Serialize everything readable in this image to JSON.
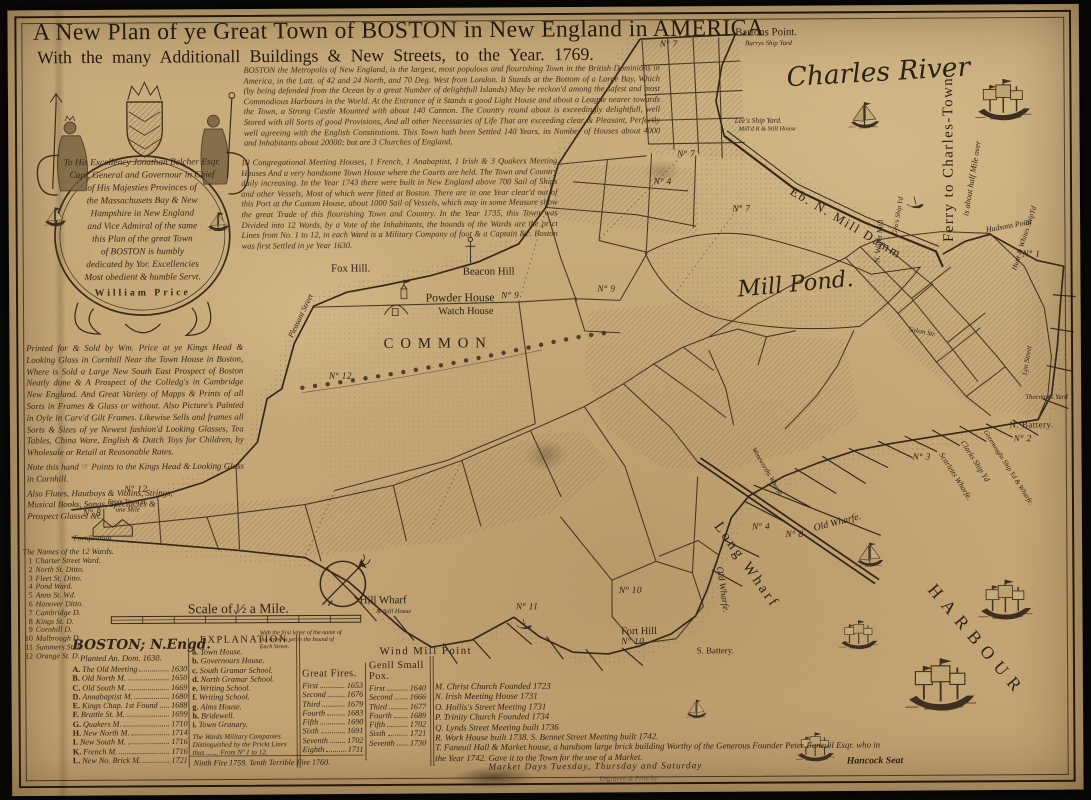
{
  "colors": {
    "paper": "#c9ad7d",
    "ink": "#2b2115",
    "faded_ink": "#6b5638",
    "backdrop": "#0b0a08"
  },
  "title": {
    "line1": "A New Plan of ye Great Town of BOSTON in New England in AMERICA",
    "line2": "With the many Additionall Buildings & New Streets, to the Year. 1769."
  },
  "desc": {
    "block_a": "BOSTON the Metropolis of New England, is the largest, most populous and flourishing Town in the British Dominions in America, in the Latt. of 42 and 24 North, and 70 Deg. West from London. It Stands at the Bottom of a Large Bay, Which (by being defended from the Ocean by a great Number of delightfull Islands) May be reckon'd among the safest and most Commodious Harbours in the World. At the Entrance of it Stands a good Light House and about a League nearer towards the Town, a Strong Castle Mounted with about 140 Cannon. The Country round about is exceedingly delightfull, well Stored with all Sorts of good Provisions, And all other Necessaries of Life That are exceeding clear & Pleasant, Perfectly well agreeing with the English Constitutions. This Town hath been Settled 140 Years, its Number of Houses about 4000 and Inhabitants about 20000; but are 3 Churches of England,",
    "block_b": "10 Congregational Meeting Houses, 1 French, 1 Anabaptist, 1 Irish & 3 Quakers Meeting Houses And a very handsome Town House where the Courts are held. The Town and Country daily increasing. In the Year 1743 there were built in New England above 700 Sail of Ships and other Vessels, Most of which were fitted at Boston. There are in one Year clear'd out of this Port at the Custom House, about 1000 Sail of Vessels, which may in some Measure show the great Trade of this flourishing Town and Country. In the Year 1735, this Town was Divided into 12 Wards, by a Vote of the Inhabitants, the bounds of the Wards are the prict Lines from No. 1 to 12, in each Ward is a Military Company of foot & a Captain &c. Boston was first Settled in ye Year 1630."
  },
  "cartouche": {
    "lines": [
      "To His Excellency Jonathan Belcher Esqr.",
      "Capt. General and Governour in Chief",
      "of His Majesties Provinces of",
      "the Massachusets Bay & New",
      "Hampshire in New England",
      "and Vice Admiral of the same",
      "this Plan of the great Town",
      "of BOSTON is humbly",
      "dedicated by Yor. Excellencies",
      "Most obedient & humble Servt.",
      "William Price"
    ]
  },
  "publisher": {
    "main": "Printed for & Sold by Wm. Price at ye Kings Head & Looking Glass in Cornhill Near the Town House in Boston, Where is Sold a Large New South East Prospect of Boston Neatly done & A Prospect of the Colledg's in Cambridge New England. And Great Variety of Mapps & Prints of all Sorts in Frames & Glass or without. Also Picture's Painted in Oyle in Carv'd Gilt Frames. Likewise Sells and frames all Sorts & Sizes of ye Newest fashion'd Looking Glasses, Tea Tables, China Ware, English & Dutch Toys for Children, by Wholesale or Retail at Reasonable Rates.",
    "hand_note": "Note this hand ☞ Points to the Kings Head & Looking Glass in Cornhill.",
    "extras": "Also Flutes, Hautboys & Violins, Strings, Musical Books, Songs, Spectacles & Prospect Glasses &c."
  },
  "wards": {
    "title": "The Names of the 12 Wards.",
    "items": [
      [
        "1",
        "Charter Street Ward."
      ],
      [
        "2",
        "North St. Ditto."
      ],
      [
        "3",
        "Fleet St. Ditto."
      ],
      [
        "4",
        "Pond Ward."
      ],
      [
        "5",
        "Anns St. Wd."
      ],
      [
        "6",
        "Hanover Ditto."
      ],
      [
        "7",
        "Cambridge D."
      ],
      [
        "8",
        "Kings St. D."
      ],
      [
        "9",
        "Cornhill D."
      ],
      [
        "10",
        "Malbrough D."
      ],
      [
        "11",
        "Summers St. D."
      ],
      [
        "12",
        "Orange St. D."
      ]
    ]
  },
  "legend": {
    "planted_title": "BOSTON; N.Engd.",
    "planted_sub": "Planted An. Dom. 1630.",
    "buildings": [
      [
        "A",
        "The Old Meeting",
        "1630"
      ],
      [
        "B",
        "Old North M.",
        "1650"
      ],
      [
        "C",
        "Old South M.",
        "1669"
      ],
      [
        "D",
        "Annabaptist M.",
        "1680"
      ],
      [
        "E",
        "Kings Chap. 1st Found",
        "1688"
      ],
      [
        "F",
        "Brattle St. M.",
        "1699"
      ],
      [
        "G",
        "Quakers M.",
        "1710"
      ],
      [
        "H",
        "New North M.",
        "1714"
      ],
      [
        "I",
        "New South M.",
        "1716"
      ],
      [
        "K",
        "French M.",
        "1716"
      ],
      [
        "L",
        "New No. Brick M.",
        "1721"
      ]
    ],
    "public_buildings": [
      [
        "a",
        "Town House."
      ],
      [
        "b",
        "Governours House."
      ],
      [
        "c",
        "South Gramar School."
      ],
      [
        "d",
        "North Gramar School."
      ],
      [
        "e",
        "Writing School."
      ],
      [
        "f",
        "Writing School."
      ],
      [
        "g",
        "Alms House."
      ],
      [
        "h",
        "Bridewell."
      ],
      [
        "i",
        "Town Granary."
      ]
    ],
    "military_note": "The Wards Military Companies Distinguished by the Prickt Lines thus ....... From Nº 1 to 12.",
    "explanation_title": "EXPLANATION.",
    "explanation_note": "With the first letter of the name of the street is set to the bound of Each Street.",
    "fires": {
      "title": "Great Fires.",
      "rows": [
        [
          "First",
          "1653"
        ],
        [
          "Second",
          "1676"
        ],
        [
          "Third",
          "1679"
        ],
        [
          "Fourth",
          "1683"
        ],
        [
          "Fifth",
          "1690"
        ],
        [
          "Sixth",
          "1691"
        ],
        [
          "Seventh",
          "1702"
        ],
        [
          "Eighth",
          "1711"
        ]
      ],
      "footer": "Ninth Fire 1759.  Tenth Terrible Fire 1760."
    },
    "pox": {
      "title": "Genll Small Pox.",
      "rows": [
        [
          "First",
          "1640"
        ],
        [
          "Second",
          "1666"
        ],
        [
          "Third",
          "1677"
        ],
        [
          "Fourth",
          "1689"
        ],
        [
          "Fifth",
          "1702"
        ],
        [
          "Sixth",
          "1721"
        ],
        [
          "Seventh",
          "1730"
        ]
      ]
    },
    "churches": [
      "M. Christ Church Founded 1723",
      "N. Irish Meeting House 1731",
      "O. Hollis's Street Meeting 1731",
      "P. Trinity Church Founded 1734",
      "Q. Lynds Street Meeting built 1736",
      "R. Work House built 1738.     S. Bennet Street Meeting built 1742."
    ],
    "faneuil": "T. Faneuil Hall & Market house, a handsom large brick building Worthy of the Generous Founder Peter Faneuil Esqr. who in the Year 1742. Gave it to the Town for the use of a Market.",
    "market_days": "Market Days Tuesday, Thursday and Saturday"
  },
  "map_labels": [
    {
      "id": "bartons-point",
      "t": "Bartons Point.",
      "x": 741,
      "y": 21,
      "fs": 11
    },
    {
      "id": "barrys-ship-yard",
      "t": "Barrys Ship Yard",
      "x": 751,
      "y": 34,
      "cls": "it",
      "fs": 7
    },
    {
      "id": "charles-river",
      "t": "Charles River",
      "x": 793,
      "y": 58,
      "rot": -3,
      "cls": "script",
      "fs": 27
    },
    {
      "id": "ferry-charlestown",
      "t": "Ferry to Charles-Town",
      "x": 958,
      "y": 233,
      "rot": -90,
      "fs": 15,
      "ls": 1.5
    },
    {
      "id": "ferry-note",
      "t": "is about half Mile over",
      "x": 974,
      "y": 210,
      "rot": -80,
      "cls": "it",
      "fs": 8.5
    },
    {
      "id": "lees-ship-yard",
      "t": "Lee's Ship Yard.",
      "x": 740,
      "y": 112,
      "cls": "it",
      "fs": 7.5
    },
    {
      "id": "still-house",
      "t": "Mill'd R & Still House",
      "x": 744,
      "y": 122,
      "cls": "it",
      "fs": 6.5
    },
    {
      "id": "mill-damm",
      "t": "Eb. N. Mill Damm",
      "x": 797,
      "y": 180,
      "rot": 31,
      "fs": 13,
      "ls": 2
    },
    {
      "id": "n-water-mill",
      "t": "N. Water Mill",
      "x": 884,
      "y": 258,
      "rot": -85,
      "fs": 8
    },
    {
      "id": "geos-ship-yard",
      "t": "Geo's Ship Yd",
      "x": 902,
      "y": 230,
      "rot": -80,
      "cls": "it",
      "fs": 7
    },
    {
      "id": "hudsons-point",
      "t": "Hudsons Point",
      "x": 995,
      "y": 225,
      "rot": -10,
      "cls": "it",
      "fs": 8
    },
    {
      "id": "hunt-whites-ship-yard",
      "t": "Hunt & Whites ShipYd",
      "x": 1023,
      "y": 266,
      "rot": -72,
      "cls": "it",
      "fs": 7.5
    },
    {
      "id": "mill-pond",
      "t": "Mill Pond.",
      "x": 742,
      "y": 276,
      "rot": -5,
      "cls": "script",
      "fs": 23
    },
    {
      "id": "fox-hill",
      "t": "Fox Hill.",
      "x": 328,
      "y": 259,
      "fs": 11
    },
    {
      "id": "beacon-hill",
      "t": "Beacon Hill",
      "x": 462,
      "y": 263,
      "fs": 11
    },
    {
      "id": "powder-house",
      "t": "Powder House",
      "x": 424,
      "y": 288,
      "fs": 12
    },
    {
      "id": "watch-house",
      "t": "Watch House",
      "x": 437,
      "y": 304,
      "fs": 10.5
    },
    {
      "id": "common",
      "t": "COMMON",
      "x": 381,
      "y": 334,
      "fs": 15,
      "ls": 7
    },
    {
      "id": "pleasant-street",
      "t": "Pleasant Street",
      "x": 286,
      "y": 330,
      "rot": -64,
      "cls": "it",
      "fs": 8
    },
    {
      "id": "wind-mill-point",
      "t": "Wind Mill Point",
      "x": 375,
      "y": 649,
      "fs": 11,
      "ls": 1.5
    },
    {
      "id": "fort-hill",
      "t": "Fort Hill",
      "x": 621,
      "y": 631,
      "fs": 10.5
    },
    {
      "id": "s-battery",
      "t": "S. Battery.",
      "x": 698,
      "y": 651,
      "fs": 9
    },
    {
      "id": "n-battery",
      "t": "N. Battery.",
      "x": 1018,
      "y": 423,
      "fs": 9,
      "ls": 0.5
    },
    {
      "id": "old-wharf",
      "t": "Old Wharfe.",
      "x": 818,
      "y": 527,
      "rot": -14,
      "cls": "it",
      "fs": 10
    },
    {
      "id": "old-wharf-2",
      "t": "Old Wharfe.",
      "x": 721,
      "y": 566,
      "rot": 82,
      "cls": "it",
      "fs": 9.5
    },
    {
      "id": "long-wharf",
      "t": "Long Wharf",
      "x": 719,
      "y": 519,
      "rot": 55,
      "fs": 15,
      "ls": 3
    },
    {
      "id": "hill-wharf",
      "t": "Hill Wharf",
      "x": 355,
      "y": 597,
      "fs": 11
    },
    {
      "id": "hill-wharf-note",
      "t": "& Still House",
      "x": 372,
      "y": 611,
      "cls": "it",
      "fs": 6.5
    },
    {
      "id": "harbour",
      "t": "HARBOUR",
      "x": 937,
      "y": 582,
      "rot": 50,
      "fs": 18,
      "ls": 8
    },
    {
      "id": "hancock-seat",
      "t": "Hancock Seat",
      "x": 850,
      "y": 764,
      "cls": "it b",
      "fs": 10
    },
    {
      "id": "fortification",
      "t": "Fortification",
      "x": 64,
      "y": 533,
      "cls": "it",
      "fs": 7.5
    },
    {
      "id": "scale-label",
      "t": "Scale of ½ a Mile.",
      "x": 180,
      "y": 604,
      "fs": 14
    },
    {
      "id": "from-town-h",
      "t": "From Town H.",
      "x": 99,
      "y": 497,
      "cls": "it",
      "fs": 7
    },
    {
      "id": "one-mile",
      "t": "one Mile",
      "x": 107,
      "y": 505,
      "cls": "it",
      "fs": 7
    },
    {
      "id": "salem-street",
      "t": "Salem Str.",
      "x": 916,
      "y": 326,
      "rot": 12,
      "cls": "it",
      "fs": 7
    },
    {
      "id": "lyn-street",
      "t": "Lyn Street",
      "x": 1033,
      "y": 373,
      "rot": -80,
      "cls": "it",
      "fs": 7.5
    },
    {
      "id": "thorntons-yard",
      "t": "Thorntons Yard",
      "x": 1034,
      "y": 396,
      "cls": "it",
      "fs": 7
    },
    {
      "id": "scarletts-wharfe",
      "t": "Scarletts Wharfe.",
      "x": 948,
      "y": 452,
      "rot": 58,
      "cls": "it",
      "fs": 8
    },
    {
      "id": "clarks-ship-yd",
      "t": "Clarks Ship Yd",
      "x": 970,
      "y": 440,
      "rot": 58,
      "cls": "it",
      "fs": 8
    },
    {
      "id": "greenoughs-ship-yd",
      "t": "Greenoughs Ship Yd & Wharfe.",
      "x": 993,
      "y": 430,
      "rot": 58,
      "cls": "it",
      "fs": 7
    },
    {
      "id": "wentworths-wharfe",
      "t": "Wentworths Wharfe",
      "x": 757,
      "y": 446,
      "rot": 60,
      "cls": "it",
      "fs": 7
    },
    {
      "id": "engraver",
      "t": "Engraven & Print by",
      "x": 598,
      "y": 782,
      "cls": "it faded",
      "fs": 7
    }
  ],
  "ward_numbers": [
    [
      "Nº 7",
      664,
      34
    ],
    [
      "Nº 7",
      681,
      146
    ],
    [
      "Nº 7",
      737,
      202
    ],
    [
      "Nº 4",
      657,
      174
    ],
    [
      "Nº 9",
      501,
      289
    ],
    [
      "Nº 9",
      599,
      283
    ],
    [
      "Nº 12",
      325,
      370
    ],
    [
      "Nº 12",
      116,
      484
    ],
    [
      "Nº 8",
      74,
      508
    ],
    [
      "Nº 8",
      789,
      534
    ],
    [
      "Nº 4",
      755,
      526
    ],
    [
      "Nº 11",
      514,
      606
    ],
    [
      "Nº 10",
      619,
      590
    ],
    [
      "Nº 10",
      621,
      642
    ],
    [
      "Nº 1",
      1032,
      250
    ],
    [
      "Nº 2",
      1022,
      438
    ],
    [
      "Nº 3",
      919,
      456
    ]
  ],
  "ships": [
    [
      "ship",
      985,
      70,
      1.5
    ],
    [
      "sloop",
      856,
      94,
      1.15
    ],
    [
      "boat",
      914,
      199,
      1
    ],
    [
      "sloop",
      860,
      543,
      1.05
    ],
    [
      "ship",
      843,
      622,
      1.05
    ],
    [
      "ship",
      910,
      658,
      1.9
    ],
    [
      "ship",
      985,
      580,
      1.45
    ],
    [
      "ship",
      798,
      736,
      1.05
    ],
    [
      "sloop",
      686,
      703,
      0.8
    ],
    [
      "boat",
      514,
      626,
      0.9
    ]
  ]
}
